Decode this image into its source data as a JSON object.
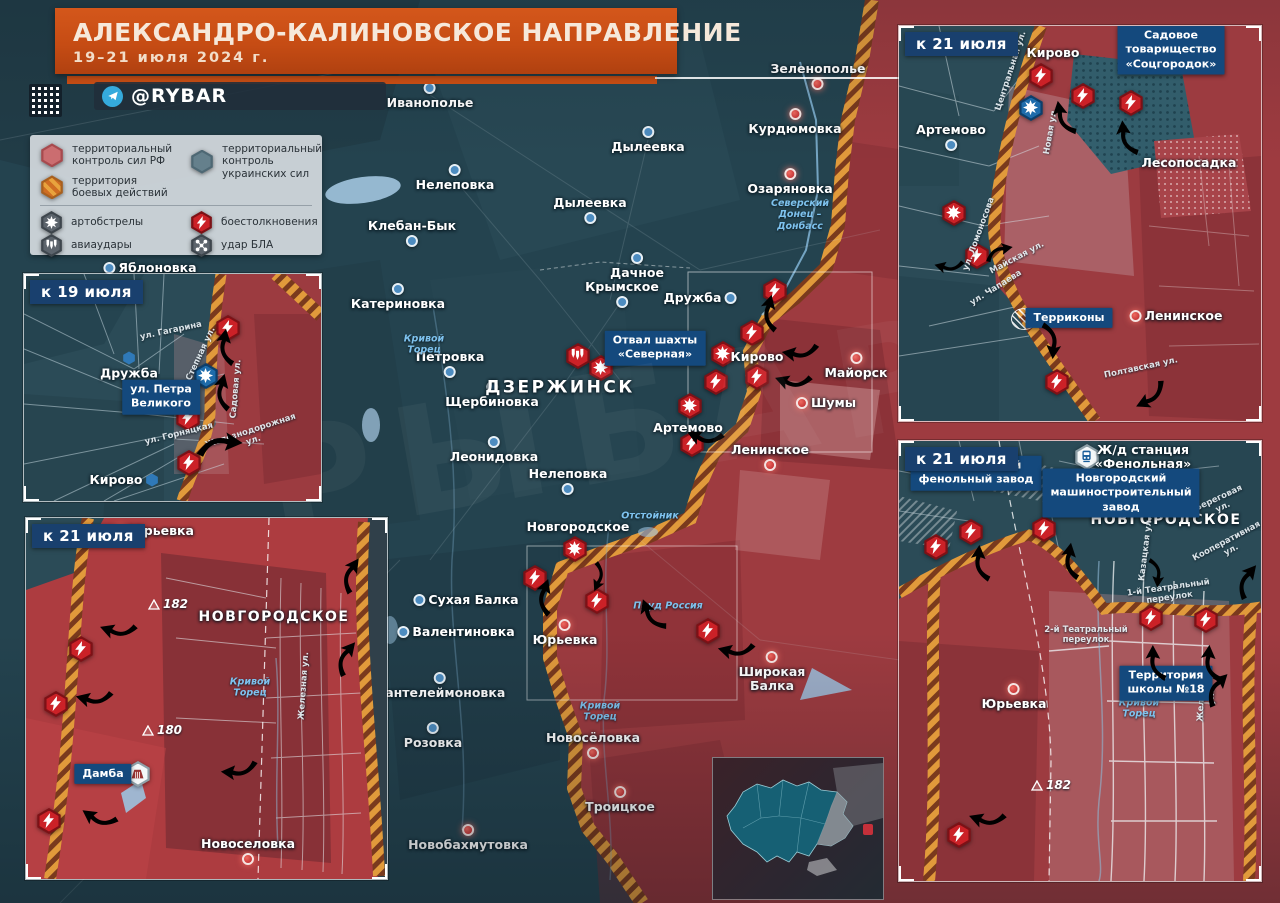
{
  "header": {
    "title": "АЛЕКСАНДРО-КАЛИНОВСКОЕ НАПРАВЛЕНИЕ",
    "date": "19–21 июля 2024 г.",
    "channel": "@RYBAR"
  },
  "watermark": "РЫБАРЬ",
  "legend": {
    "items": [
      {
        "id": "rf_control",
        "label": "территориальный\nконтроль сил РФ"
      },
      {
        "id": "ua_control",
        "label": "территориальный\nконтроль украинских сил"
      },
      {
        "id": "combat_zone",
        "label": "территория\nбоевых действий"
      },
      {
        "id": "artillery",
        "label": "артобстрелы"
      },
      {
        "id": "clashes",
        "label": "боестолкновения"
      },
      {
        "id": "airstrikes",
        "label": "авиаудары"
      },
      {
        "id": "uav_strike",
        "label": "удар БЛА"
      }
    ]
  },
  "maps": {
    "main": {
      "places": [
        {
          "n": "Иванополье",
          "x": 430,
          "y": 96,
          "m": "ua",
          "mp": "above"
        },
        {
          "n": "Зеленополье",
          "x": 818,
          "y": 76,
          "m": "ru",
          "mp": "below"
        },
        {
          "n": "Курдюмовка",
          "x": 795,
          "y": 122,
          "m": "ru",
          "mp": "above"
        },
        {
          "n": "Дылеевка",
          "x": 648,
          "y": 140,
          "m": "ua",
          "mp": "above"
        },
        {
          "n": "Нелеповка",
          "x": 455,
          "y": 178,
          "m": "ua",
          "mp": "above"
        },
        {
          "n": "Озаряновка",
          "x": 790,
          "y": 182,
          "m": "ru",
          "mp": "above"
        },
        {
          "n": "Дылеевка",
          "x": 590,
          "y": 210,
          "m": "ua",
          "mp": "below"
        },
        {
          "n": "Клебан-Бык",
          "x": 412,
          "y": 233,
          "m": "ua",
          "mp": "below"
        },
        {
          "n": "Дачное",
          "x": 637,
          "y": 266,
          "m": "ua",
          "mp": "above"
        },
        {
          "n": "Катериновка",
          "x": 398,
          "y": 297,
          "m": "ua",
          "mp": "above"
        },
        {
          "n": "Крымское",
          "x": 622,
          "y": 294,
          "m": "ua",
          "mp": "below"
        },
        {
          "n": "Дружба",
          "x": 700,
          "y": 298,
          "m": "ua",
          "mp": "right"
        },
        {
          "n": "Яблоновка",
          "x": 150,
          "y": 268,
          "m": "ua",
          "mp": "left"
        },
        {
          "n": "Петровка",
          "x": 450,
          "y": 364,
          "m": "ua",
          "mp": "below"
        },
        {
          "n": "Щербиновка",
          "x": 492,
          "y": 395,
          "m": "ua",
          "mp": "above"
        },
        {
          "n": "ДЗЕРЖИНСК",
          "x": 560,
          "y": 388,
          "cls": "city"
        },
        {
          "n": "Кирово",
          "x": 757,
          "y": 357
        },
        {
          "n": "Майорск",
          "x": 856,
          "y": 366,
          "m": "ru",
          "mp": "above"
        },
        {
          "n": "Шумы",
          "x": 826,
          "y": 403,
          "m": "ru",
          "mp": "left"
        },
        {
          "n": "Артемово",
          "x": 688,
          "y": 428
        },
        {
          "n": "Ленинское",
          "x": 770,
          "y": 457,
          "m": "ru",
          "mp": "below"
        },
        {
          "n": "Леонидовка",
          "x": 494,
          "y": 450,
          "m": "ua",
          "mp": "above"
        },
        {
          "n": "Нелеповка",
          "x": 568,
          "y": 481,
          "m": "ua",
          "mp": "below"
        },
        {
          "n": "Новгородское",
          "x": 578,
          "y": 527
        },
        {
          "n": "Сухая Балка",
          "x": 466,
          "y": 600,
          "m": "ua",
          "mp": "left"
        },
        {
          "n": "Валентиновка",
          "x": 456,
          "y": 632,
          "m": "ua",
          "mp": "left"
        },
        {
          "n": "Пантелеймоновка",
          "x": 440,
          "y": 686,
          "m": "ua",
          "mp": "above"
        },
        {
          "n": "Юрьевка",
          "x": 565,
          "y": 633,
          "m": "ru",
          "mp": "above"
        },
        {
          "n": "Широкая\nБалка",
          "x": 772,
          "y": 672,
          "m": "ru",
          "mp": "above"
        },
        {
          "n": "Розовка",
          "x": 433,
          "y": 736,
          "m": "ua",
          "mp": "above"
        },
        {
          "n": "Новосёловка",
          "x": 593,
          "y": 745,
          "m": "ru",
          "mp": "below"
        },
        {
          "n": "Троицкое",
          "x": 620,
          "y": 800,
          "m": "ru",
          "mp": "above"
        },
        {
          "n": "Новобахмутовка",
          "x": 468,
          "y": 838,
          "m": "ru",
          "mp": "above"
        }
      ],
      "boxes": [
        {
          "n": "Отвал шахты\n«Северная»",
          "x": 655,
          "y": 348
        }
      ],
      "rivers": [
        {
          "n": "Северский\nДонец –\nДонбасс",
          "x": 800,
          "y": 215
        },
        {
          "n": "Кривой\nТорец",
          "x": 424,
          "y": 345
        },
        {
          "n": "Отстойник",
          "x": 650,
          "y": 516
        },
        {
          "n": "Пруд Россия",
          "x": 668,
          "y": 606
        },
        {
          "n": "Кривой\nТорец",
          "x": 600,
          "y": 712
        }
      ],
      "streets": [],
      "heights": [],
      "icons": [
        {
          "t": "bolt",
          "x": 775,
          "y": 291
        },
        {
          "t": "bolt",
          "x": 752,
          "y": 333
        },
        {
          "t": "burst",
          "x": 723,
          "y": 354
        },
        {
          "t": "bombs",
          "x": 578,
          "y": 356
        },
        {
          "t": "burst",
          "x": 601,
          "y": 368
        },
        {
          "t": "bolt",
          "x": 716,
          "y": 382
        },
        {
          "t": "bolt",
          "x": 757,
          "y": 377
        },
        {
          "t": "burst",
          "x": 690,
          "y": 406
        },
        {
          "t": "bolt",
          "x": 692,
          "y": 444
        },
        {
          "t": "burst",
          "x": 575,
          "y": 549
        },
        {
          "t": "bolt",
          "x": 535,
          "y": 578
        },
        {
          "t": "bolt",
          "x": 597,
          "y": 601
        },
        {
          "t": "bolt",
          "x": 708,
          "y": 631
        }
      ],
      "arrows": [
        {
          "x": 770,
          "y": 313,
          "r": -75
        },
        {
          "x": 800,
          "y": 352,
          "r": 190
        },
        {
          "x": 793,
          "y": 381,
          "r": 200
        },
        {
          "x": 705,
          "y": 437,
          "r": 205
        },
        {
          "x": 545,
          "y": 597,
          "r": -70
        },
        {
          "x": 652,
          "y": 615,
          "r": -110
        },
        {
          "x": 736,
          "y": 650,
          "r": 195
        },
        {
          "x": 598,
          "y": 577,
          "r": 115,
          "c": "blue",
          "s": 0.8
        }
      ]
    },
    "inset19": {
      "label": "к 19 июля",
      "places": [
        {
          "n": "Дружба",
          "x": 105,
          "y": 92,
          "m": "hex",
          "mp": "above"
        },
        {
          "n": "Кирово",
          "x": 100,
          "y": 206,
          "m": "hex",
          "mp": "right"
        }
      ],
      "boxes": [
        {
          "n": "ул. Петра\nВеликого",
          "x": 137,
          "y": 123
        }
      ],
      "rivers": [],
      "streets": [
        {
          "n": "ул. Гагарина",
          "x": 147,
          "y": 57,
          "r": -12
        },
        {
          "n": "Степная ул.",
          "x": 177,
          "y": 80,
          "r": -65
        },
        {
          "n": "Садовая ул.",
          "x": 212,
          "y": 115,
          "r": -85
        },
        {
          "n": "ул. Горняцкая",
          "x": 155,
          "y": 160,
          "r": -14
        },
        {
          "n": "Железнодорожная ул.",
          "x": 228,
          "y": 162,
          "r": -18
        }
      ],
      "heights": [],
      "icons": [
        {
          "t": "bolt",
          "x": 204,
          "y": 54
        },
        {
          "t": "burst",
          "c": "blue",
          "x": 182,
          "y": 102
        },
        {
          "t": "bolt",
          "x": 164,
          "y": 144
        },
        {
          "t": "bolt",
          "x": 165,
          "y": 189
        }
      ],
      "arrows": [
        {
          "x": 202,
          "y": 73,
          "r": -80
        },
        {
          "x": 199,
          "y": 118,
          "r": -75
        },
        {
          "x": 196,
          "y": 171,
          "r": 5,
          "s": 1.25
        }
      ]
    },
    "inset21sw": {
      "label": "к 21 июля",
      "places": [
        {
          "n": "Юрьевка",
          "x": 128,
          "y": 13,
          "m": "ru",
          "mp": "left"
        },
        {
          "n": "НОВГОРОДСКОЕ",
          "x": 248,
          "y": 100,
          "cls": "city2"
        },
        {
          "n": "Новоселовка",
          "x": 222,
          "y": 333,
          "m": "ru",
          "mp": "below"
        }
      ],
      "boxes": [
        {
          "n": "Дамба",
          "x": 77,
          "y": 256
        }
      ],
      "rivers": [
        {
          "n": "Кривой\nТорец",
          "x": 224,
          "y": 170
        }
      ],
      "streets": [
        {
          "n": "Железная ул.",
          "x": 278,
          "y": 168,
          "r": -86
        }
      ],
      "heights": [
        {
          "v": "182",
          "x": 142,
          "y": 86
        },
        {
          "v": "180",
          "x": 136,
          "y": 212
        }
      ],
      "icons": [
        {
          "t": "bolt",
          "x": 55,
          "y": 131
        },
        {
          "t": "bolt",
          "x": 30,
          "y": 186
        },
        {
          "t": "bolt",
          "x": 23,
          "y": 303
        },
        {
          "t": "dam",
          "c": "white",
          "x": 112,
          "y": 256
        }
      ],
      "arrows": [
        {
          "x": 92,
          "y": 112,
          "r": 200
        },
        {
          "x": 68,
          "y": 180,
          "r": 195
        },
        {
          "x": 213,
          "y": 252,
          "r": 185
        },
        {
          "x": 73,
          "y": 300,
          "r": 215
        },
        {
          "x": 325,
          "y": 57,
          "r": -55
        },
        {
          "x": 320,
          "y": 140,
          "r": -50
        }
      ]
    },
    "inset21ne": {
      "label": "к 21 июля",
      "places": [
        {
          "n": "Кирово",
          "x": 154,
          "y": 27
        },
        {
          "n": "Артемово",
          "x": 52,
          "y": 111,
          "m": "ua",
          "mp": "below"
        },
        {
          "n": "Лесопосадка",
          "x": 290,
          "y": 137
        },
        {
          "n": "Ленинское",
          "x": 277,
          "y": 290,
          "m": "ru",
          "mp": "left"
        }
      ],
      "boxes": [
        {
          "n": "Садовое товарищество\n«Соцгородок»",
          "x": 272,
          "y": 24
        },
        {
          "n": "Терриконы",
          "x": 170,
          "y": 292
        }
      ],
      "rivers": [],
      "streets": [
        {
          "n": "Центральная ул.",
          "x": 112,
          "y": 45,
          "r": -72
        },
        {
          "n": "Новая ул.",
          "x": 152,
          "y": 105,
          "r": -80
        },
        {
          "n": "ул. Ломоносова",
          "x": 80,
          "y": 208,
          "r": -70
        },
        {
          "n": "Майская ул.",
          "x": 118,
          "y": 232,
          "r": -28
        },
        {
          "n": "ул. Чапаева",
          "x": 97,
          "y": 262,
          "r": -32
        },
        {
          "n": "Полтавская ул.",
          "x": 242,
          "y": 342,
          "r": -12
        }
      ],
      "heights": [],
      "icons": [
        {
          "t": "bolt",
          "x": 142,
          "y": 50
        },
        {
          "t": "bolt",
          "x": 184,
          "y": 70
        },
        {
          "t": "bolt",
          "x": 232,
          "y": 77
        },
        {
          "t": "burst",
          "c": "blue",
          "x": 132,
          "y": 82
        },
        {
          "t": "burst",
          "x": 55,
          "y": 187
        },
        {
          "t": "bolt",
          "x": 78,
          "y": 230
        },
        {
          "t": "bolt",
          "x": 158,
          "y": 356
        },
        {
          "t": "terricon",
          "x": 125,
          "y": 293
        }
      ],
      "arrows": [
        {
          "x": 165,
          "y": 92,
          "r": -100
        },
        {
          "x": 228,
          "y": 112,
          "r": -95
        },
        {
          "x": 100,
          "y": 226,
          "r": -10,
          "s": 0.8
        },
        {
          "x": 152,
          "y": 315,
          "r": 95
        },
        {
          "x": 252,
          "y": 370,
          "r": 155
        },
        {
          "x": 50,
          "y": 240,
          "r": 195,
          "c": "blue",
          "s": 0.8
        }
      ]
    },
    "inset21e": {
      "label": "к 21 июля",
      "places": [
        {
          "n": "НОВГОРОДСКОЕ",
          "x": 267,
          "y": 80,
          "cls": "city2"
        },
        {
          "n": "Ж/д станция\n«Фенольная»",
          "x": 244,
          "y": 16
        },
        {
          "n": "Юрьевка",
          "x": 115,
          "y": 256,
          "m": "ru",
          "mp": "above"
        }
      ],
      "boxes": [
        {
          "n": "Новгородский\nфенольный завод",
          "x": 77,
          "y": 32
        },
        {
          "n": "Новгородский\nмашиностроительный завод",
          "x": 222,
          "y": 52
        },
        {
          "n": "Территория\nшколы №18",
          "x": 267,
          "y": 242
        }
      ],
      "rivers": [
        {
          "n": "Кривой\nТорец",
          "x": 240,
          "y": 268
        }
      ],
      "streets": [
        {
          "n": "Казацкая ул.",
          "x": 247,
          "y": 108,
          "r": -83
        },
        {
          "n": "Береговая ул.",
          "x": 322,
          "y": 62,
          "r": -25
        },
        {
          "n": "Кооперативная ул.",
          "x": 330,
          "y": 105,
          "r": -28
        },
        {
          "n": "1-й Театральный\nпереулок",
          "x": 270,
          "y": 152,
          "r": -8
        },
        {
          "n": "2-й Театральный\nпереулок",
          "x": 187,
          "y": 194,
          "r": 0
        },
        {
          "n": "Железная ул.",
          "x": 308,
          "y": 256,
          "r": -87
        }
      ],
      "heights": [
        {
          "v": "182",
          "x": 152,
          "y": 344
        }
      ],
      "icons": [
        {
          "t": "bolt",
          "x": 37,
          "y": 106
        },
        {
          "t": "bolt",
          "x": 72,
          "y": 91
        },
        {
          "t": "bolt",
          "x": 145,
          "y": 88
        },
        {
          "t": "bolt",
          "x": 252,
          "y": 177
        },
        {
          "t": "bolt",
          "x": 307,
          "y": 179
        },
        {
          "t": "bolt",
          "x": 60,
          "y": 394
        },
        {
          "t": "train",
          "c": "white",
          "x": 188,
          "y": 16
        }
      ],
      "arrows": [
        {
          "x": 82,
          "y": 122,
          "r": -85
        },
        {
          "x": 172,
          "y": 120,
          "r": -80
        },
        {
          "x": 257,
          "y": 222,
          "r": -90
        },
        {
          "x": 312,
          "y": 222,
          "r": -85
        },
        {
          "x": 348,
          "y": 140,
          "r": -50
        },
        {
          "x": 88,
          "y": 378,
          "r": 200
        },
        {
          "x": 318,
          "y": 248,
          "r": -45
        },
        {
          "x": 257,
          "y": 132,
          "r": 95,
          "c": "blue",
          "s": 0.8
        }
      ]
    }
  }
}
